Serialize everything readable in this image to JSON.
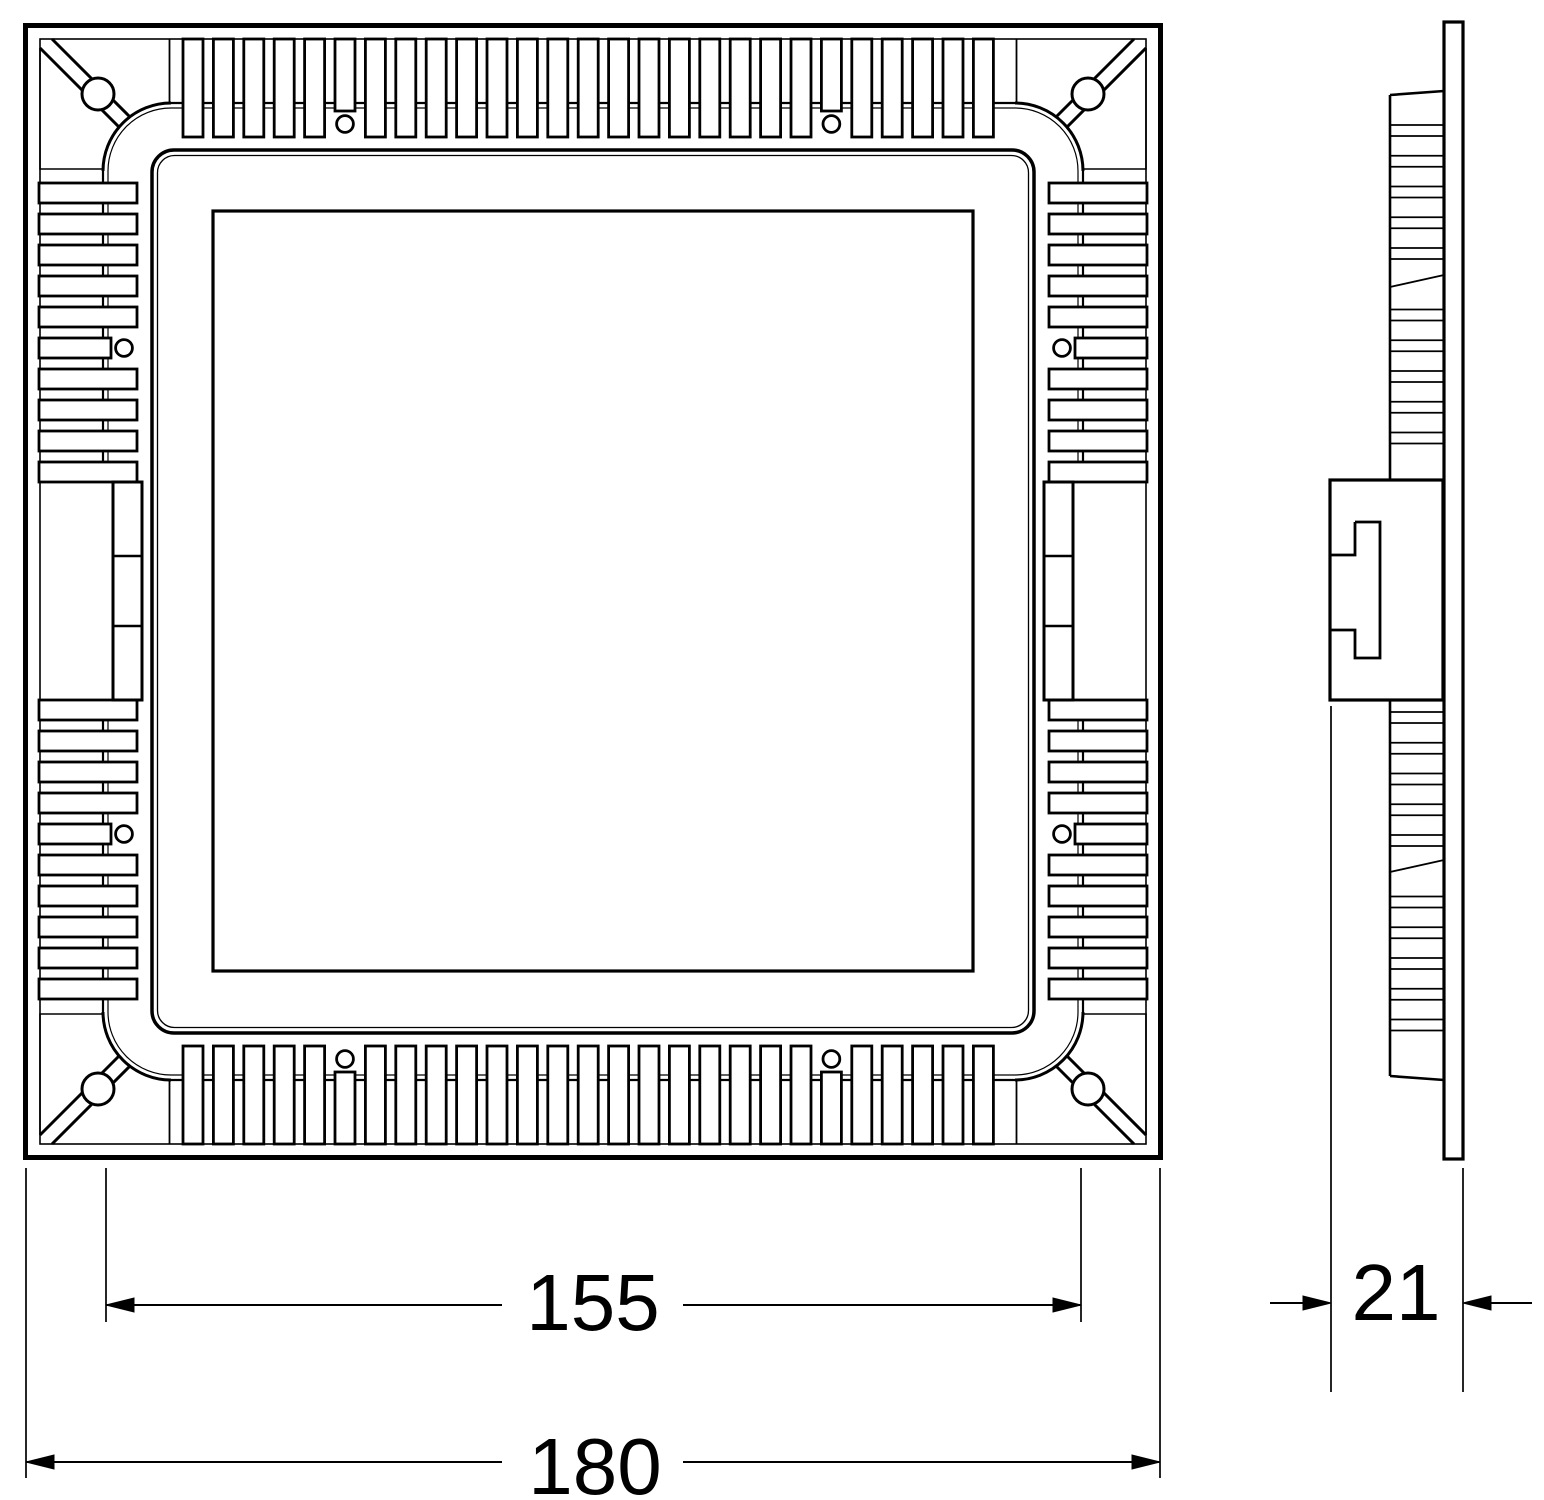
{
  "drawing": {
    "type": "technical-drawing",
    "description": "Square recessed LED panel light, rear view and side profile with dimensions",
    "line_color": "#000000",
    "background_color": "#ffffff"
  },
  "dimensions": {
    "cutout_width": {
      "value": "155",
      "orientation": "horizontal"
    },
    "overall_width": {
      "value": "180",
      "orientation": "horizontal"
    },
    "depth": {
      "value": "21",
      "orientation": "horizontal"
    }
  },
  "geometry": {
    "front": {
      "mirror_x": 1186,
      "mirror_y": 1183,
      "fin_inset": 39,
      "fin_length": 98,
      "fin_width": 20,
      "short_len": 72,
      "rail_outer": 103,
      "rail_inner": 108,
      "rail_span": [
        171,
        1015
      ],
      "top": {
        "start": 183,
        "pitch": 30.4,
        "count": 27,
        "short": [
          5,
          21
        ],
        "hole_offset": 124,
        "hole_r": 8.4
      },
      "side": {
        "pitch": 31,
        "groups": [
          {
            "start": 183,
            "count": 10,
            "short": [
              5
            ]
          },
          {
            "start": 700,
            "count": 10,
            "short": [
              4
            ]
          }
        ],
        "rail_segments": [
          [
            171,
            481
          ],
          [
            699,
            1012
          ]
        ],
        "slot": {
          "x": 113,
          "y": 482,
          "w": 29,
          "h": 218,
          "dividers": [
            556,
            626
          ]
        }
      }
    },
    "profile": {
      "x1": 1390,
      "x2": 1444,
      "pair_gap": 11,
      "pitch": 30.75,
      "rungs": [
        {
          "start": 125,
          "count": 11,
          "skip": 5,
          "diag_y": 281
        },
        {
          "start": 712,
          "count": 11,
          "skip": 5,
          "diag_y": 866
        }
      ]
    }
  }
}
